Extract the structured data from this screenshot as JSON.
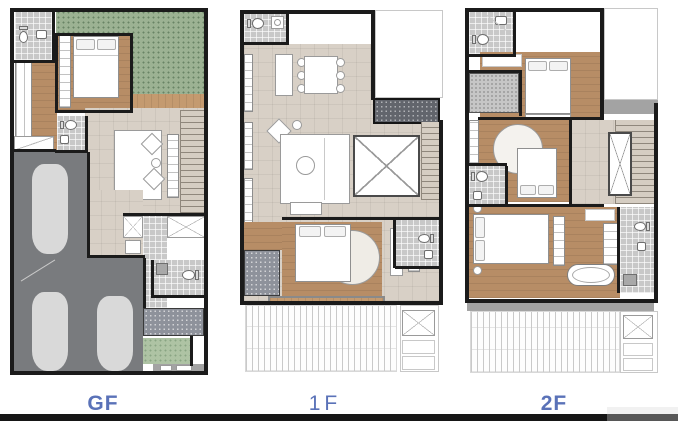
{
  "floors": [
    {
      "id": "gf",
      "label": "GF"
    },
    {
      "id": "1f",
      "label": "1F"
    },
    {
      "id": "2f",
      "label": "2F"
    }
  ],
  "palette": {
    "wall": "#1b1b1b",
    "wood": "#b78d66",
    "wood_light": "#c49a6f",
    "tile_beige": "#d8d0c6",
    "tile_gray": "#c8c8c8",
    "garden_green": "#9cb293",
    "garage_gray": "#797b7e",
    "car_gray": "#d9d9d9",
    "label_blue": "#5a72b8",
    "footer_black": "#161616",
    "footer_gray": "#575757",
    "footer_tab": "#f1f1f1"
  }
}
